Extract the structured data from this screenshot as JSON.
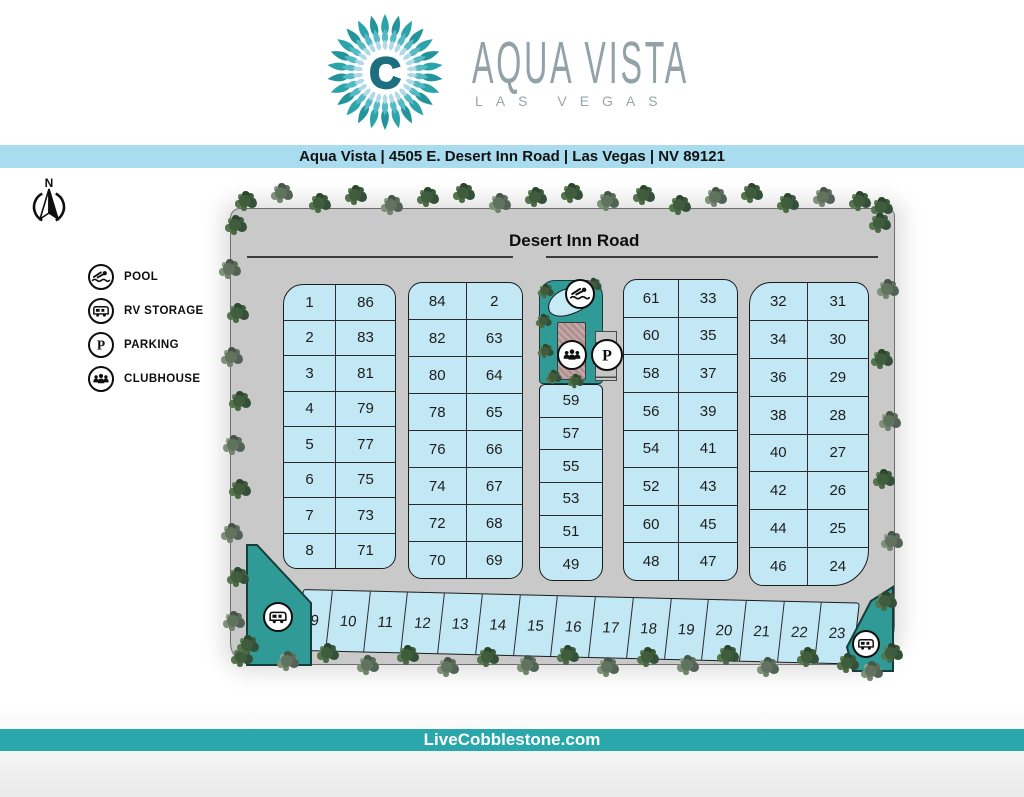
{
  "theme": {
    "banner-blue": "#a8dcee",
    "footer-teal": "#2aa7aa",
    "map-grey": "#c9c9c9",
    "lot-blue": "#c3e8f5",
    "lot-outline": "#1c1c1c",
    "amenity-teal": "#2f9a96",
    "building-mauve": "#b19090",
    "logo-teal": "#2aa3ab",
    "logo-dark-teal": "#1d6e7e"
  },
  "header": {
    "logo_center_letter": "C",
    "title": "AQUA VISTA",
    "subtitle": "LAS VEGAS"
  },
  "address_bar": {
    "text": "Aqua Vista | 4505 E. Desert Inn Road | Las Vegas | NV 89121"
  },
  "compass": {
    "label": "N"
  },
  "legend": {
    "items": [
      {
        "icon": "pool-icon",
        "label": "POOL"
      },
      {
        "icon": "rv-storage-icon",
        "label": "RV STORAGE"
      },
      {
        "icon": "parking-icon",
        "label": "PARKING"
      },
      {
        "icon": "clubhouse-icon",
        "label": "CLUBHOUSE"
      }
    ]
  },
  "site_map": {
    "road_label": "Desert Inn Road",
    "parking_symbol": "P",
    "columns": {
      "col1": {
        "left": [
          "1",
          "2",
          "3",
          "4",
          "5",
          "6",
          "7",
          "8"
        ],
        "right": [
          "86",
          "83",
          "81",
          "79",
          "77",
          "75",
          "73",
          "71"
        ]
      },
      "col2": {
        "left": [
          "84",
          "82",
          "80",
          "78",
          "76",
          "74",
          "72",
          "70"
        ],
        "right": [
          "2",
          "63",
          "64",
          "65",
          "66",
          "67",
          "68",
          "69"
        ]
      },
      "col3": {
        "cells": [
          "59",
          "57",
          "55",
          "53",
          "51",
          "49"
        ]
      },
      "col4": {
        "left": [
          "61",
          "60",
          "58",
          "56",
          "54",
          "52",
          "60",
          "48"
        ],
        "right": [
          "33",
          "35",
          "37",
          "39",
          "41",
          "43",
          "45",
          "47"
        ]
      },
      "col5": {
        "left": [
          "32",
          "34",
          "36",
          "38",
          "40",
          "42",
          "44",
          "46"
        ],
        "right": [
          "31",
          "30",
          "29",
          "28",
          "27",
          "26",
          "25",
          "24"
        ]
      }
    },
    "bottom_row": [
      "9",
      "10",
      "11",
      "12",
      "13",
      "14",
      "15",
      "16",
      "17",
      "18",
      "19",
      "20",
      "21",
      "22",
      "23"
    ]
  },
  "footer": {
    "text": "LiveCobblestone.com"
  }
}
